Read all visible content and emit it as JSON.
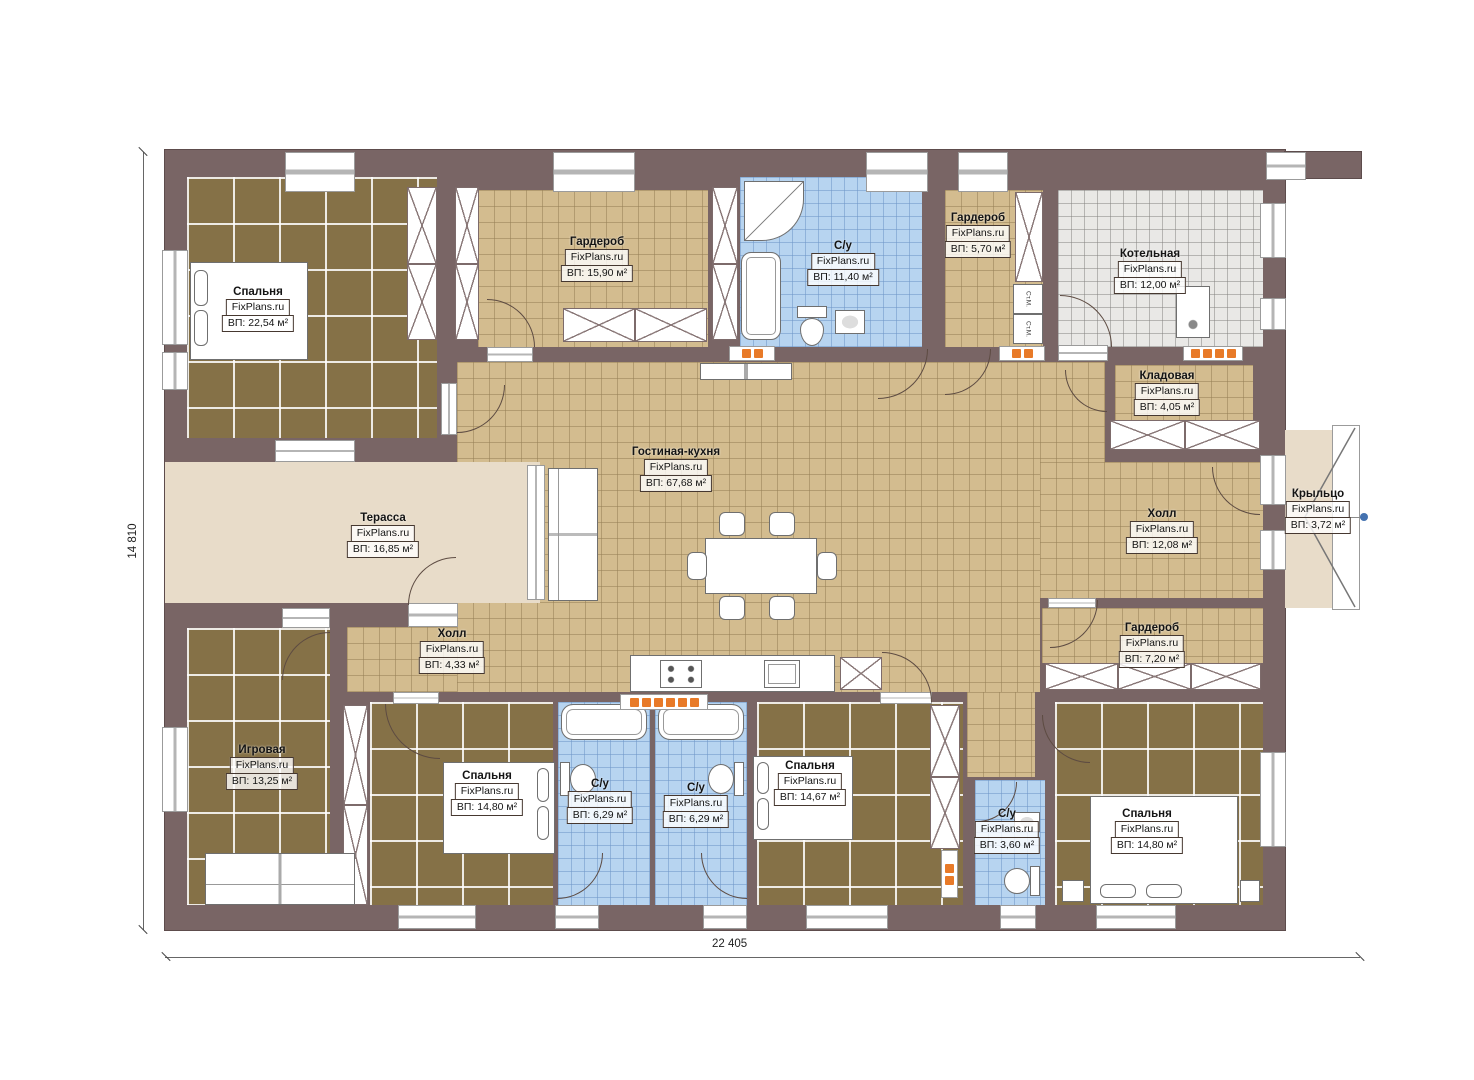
{
  "plan": {
    "site": "FixPlans.ru",
    "dimensions": {
      "width": "22 405",
      "height": "14 810"
    },
    "labels": {
      "washer": "Ст.М."
    },
    "colors": {
      "wall": "#796565",
      "wood_floor": "#857147",
      "tile_tan": "#d3bc8f",
      "tile_blue": "#b7d4f0",
      "tile_gray": "#e9e8e6",
      "deck": "#e8dcc9",
      "vent_orange": "#e87a28",
      "leader_dot_blue": "#4472b0"
    },
    "rooms": [
      {
        "name": "Спальня",
        "site": "FixPlans.ru",
        "area": "ВП: 22,54 м²"
      },
      {
        "name": "Гардероб",
        "site": "FixPlans.ru",
        "area": "ВП: 15,90 м²"
      },
      {
        "name": "С/у",
        "site": "FixPlans.ru",
        "area": "ВП: 11,40 м²"
      },
      {
        "name": "Гардероб",
        "site": "FixPlans.ru",
        "area": "ВП: 5,70 м²"
      },
      {
        "name": "Котельная",
        "site": "FixPlans.ru",
        "area": "ВП: 12,00 м²"
      },
      {
        "name": "Кладовая",
        "site": "FixPlans.ru",
        "area": "ВП: 4,05 м²"
      },
      {
        "name": "Гостиная-кухня",
        "site": "FixPlans.ru",
        "area": "ВП: 67,68 м²"
      },
      {
        "name": "Терасса",
        "site": "FixPlans.ru",
        "area": "ВП: 16,85 м²"
      },
      {
        "name": "Холл",
        "site": "FixPlans.ru",
        "area": "ВП: 12,08 м²"
      },
      {
        "name": "Крыльцо",
        "site": "FixPlans.ru",
        "area": "ВП: 3,72 м²"
      },
      {
        "name": "Холл",
        "site": "FixPlans.ru",
        "area": "ВП: 4,33 м²"
      },
      {
        "name": "Гардероб",
        "site": "FixPlans.ru",
        "area": "ВП: 7,20 м²"
      },
      {
        "name": "Игровая",
        "site": "FixPlans.ru",
        "area": "ВП: 13,25 м²"
      },
      {
        "name": "Спальня",
        "site": "FixPlans.ru",
        "area": "ВП: 14,80 м²"
      },
      {
        "name": "С/у",
        "site": "FixPlans.ru",
        "area": "ВП: 6,29 м²"
      },
      {
        "name": "С/у",
        "site": "FixPlans.ru",
        "area": "ВП: 6,29 м²"
      },
      {
        "name": "Спальня",
        "site": "FixPlans.ru",
        "area": "ВП: 14,67 м²"
      },
      {
        "name": "С/у",
        "site": "FixPlans.ru",
        "area": "ВП: 3,60 м²"
      },
      {
        "name": "Спальня",
        "site": "FixPlans.ru",
        "area": "ВП: 14,80 м²"
      }
    ]
  }
}
